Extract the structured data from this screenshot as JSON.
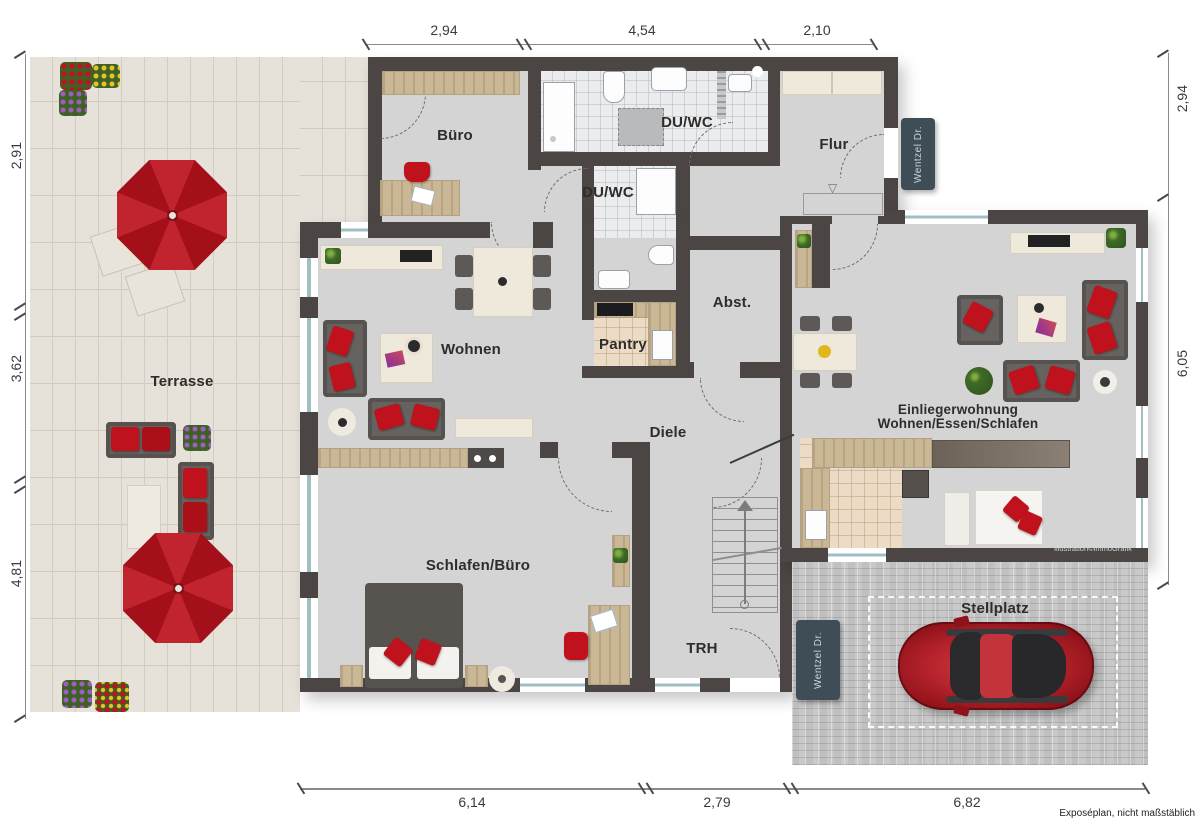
{
  "meta": {
    "footnote": "Exposéplan, nicht maßstäblich",
    "credit": "Illustration©immoGrafik",
    "street_sign": "Wentzel Dr."
  },
  "dims": {
    "top": [
      "2,94",
      "4,54",
      "2,10"
    ],
    "left": [
      "2,91",
      "3,62",
      "4,81"
    ],
    "right": [
      "2,94",
      "6,05"
    ],
    "bottom": [
      "6,14",
      "2,79",
      "6,82"
    ]
  },
  "rooms": {
    "terrasse": "Terrasse",
    "buero": "Büro",
    "du_wc_og": "DU/WC",
    "du_wc_mid": "DU/WC",
    "flur": "Flur",
    "wohnen": "Wohnen",
    "pantry": "Pantry",
    "abstellraum": "Abst.",
    "diele": "Diele",
    "schlafen_buero": "Schlafen/Büro",
    "trh": "TRH",
    "einlieger_line1": "Einliegerwohnung",
    "einlieger_line2": "Wohnen/Essen/Schlafen",
    "stellplatz": "Stellplatz"
  },
  "icons": {
    "door_marker": "▽"
  },
  "colors": {
    "wall": "#4b4644",
    "floor": "#d4d4d5",
    "terrace": "#e7e2d9",
    "paving": "#c9c9c9",
    "red": "#b4161f",
    "sign": "#3f4d57"
  }
}
